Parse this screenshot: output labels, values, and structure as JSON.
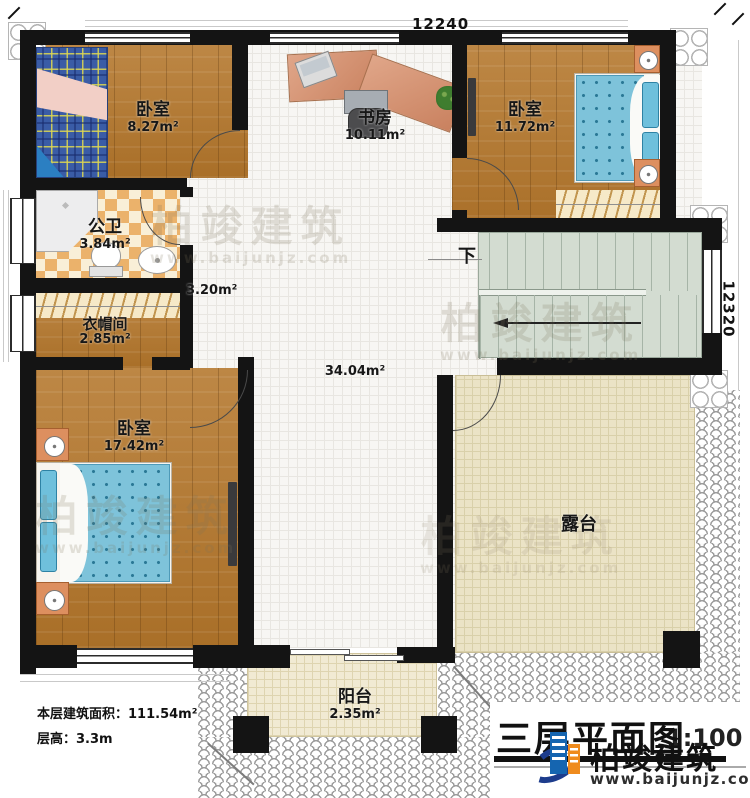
{
  "floor_plan": {
    "title": "三层平面图",
    "scale": "1:100",
    "stats": {
      "area_line": "本层建筑面积：111.54m²",
      "height_line": "层高：3.3m"
    },
    "dimensions": {
      "width": "12240",
      "depth": "12320"
    },
    "rooms": [
      {
        "id": "bedroom-top-left",
        "name": "卧室",
        "area": "8.27m²"
      },
      {
        "id": "study",
        "name": "书房",
        "area": "10.11m²"
      },
      {
        "id": "bedroom-top-right",
        "name": "卧室",
        "area": "11.72m²"
      },
      {
        "id": "bathroom",
        "name": "公卫",
        "area": "3.84m²"
      },
      {
        "id": "closet",
        "name": "衣帽间",
        "area": "2.85m²"
      },
      {
        "id": "corridor",
        "name": "",
        "area": "3.20m²"
      },
      {
        "id": "hall",
        "name": "",
        "area": "34.04m²"
      },
      {
        "id": "bedroom-bottom-left",
        "name": "卧室",
        "area": "17.42m²"
      },
      {
        "id": "terrace",
        "name": "露台",
        "area": ""
      },
      {
        "id": "balcony",
        "name": "阳台",
        "area": "2.35m²"
      }
    ],
    "stairs": {
      "down": "下"
    },
    "watermark": {
      "brand": "柏竣建筑",
      "url": "www.baijunjz.com"
    },
    "logo": {
      "brand": "柏竣建筑",
      "url": "www.baijunjz.com"
    },
    "colors": {
      "wall": "#141414",
      "wood_floor": "#b3792f",
      "tile_floor": "#f7f6f3",
      "bathroom_tile": "#ebb26b",
      "stairs": "#d3dcd1",
      "terrace": "#ebe3c6",
      "bed_blue": "#7ec3da",
      "plaid_bed_blue": "#3a5ca6",
      "desk_salmon": "#d69a7e",
      "logo_blue": "#1565b0",
      "logo_orange": "#ef8b1d"
    }
  }
}
